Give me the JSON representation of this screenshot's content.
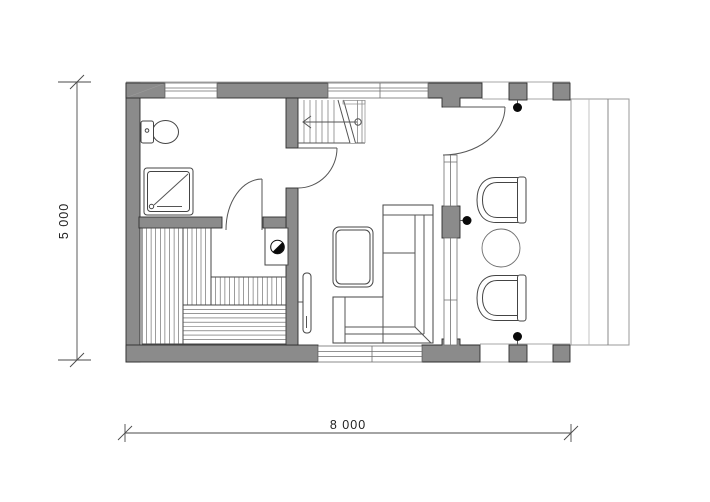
{
  "plan": {
    "type": "architectural-floor-plan",
    "dimension_labels": {
      "width": "8 000",
      "height": "5 000"
    },
    "colors": {
      "wall": "#8b8b8b",
      "wall_outline": "#2e2e2e",
      "line": "#4a4a4a",
      "light_line": "#9a9a9a",
      "column_dot": "#0a0a0a",
      "background": "#ffffff"
    },
    "elements": [
      "exterior-walls",
      "interior-walls",
      "window-top-left",
      "window-top-right",
      "window-bottom",
      "glazed-right-wall",
      "entrance-door",
      "hall-door",
      "sauna-door",
      "staircase",
      "toilet",
      "shower-tray",
      "sauna-bench-left",
      "sauna-bench-upper",
      "sauna-bench-lower",
      "sauna-stove",
      "tv",
      "coffee-table",
      "corner-sofa",
      "armchair-top",
      "armchair-bottom",
      "round-table",
      "porch-columns",
      "deck-steps"
    ]
  }
}
